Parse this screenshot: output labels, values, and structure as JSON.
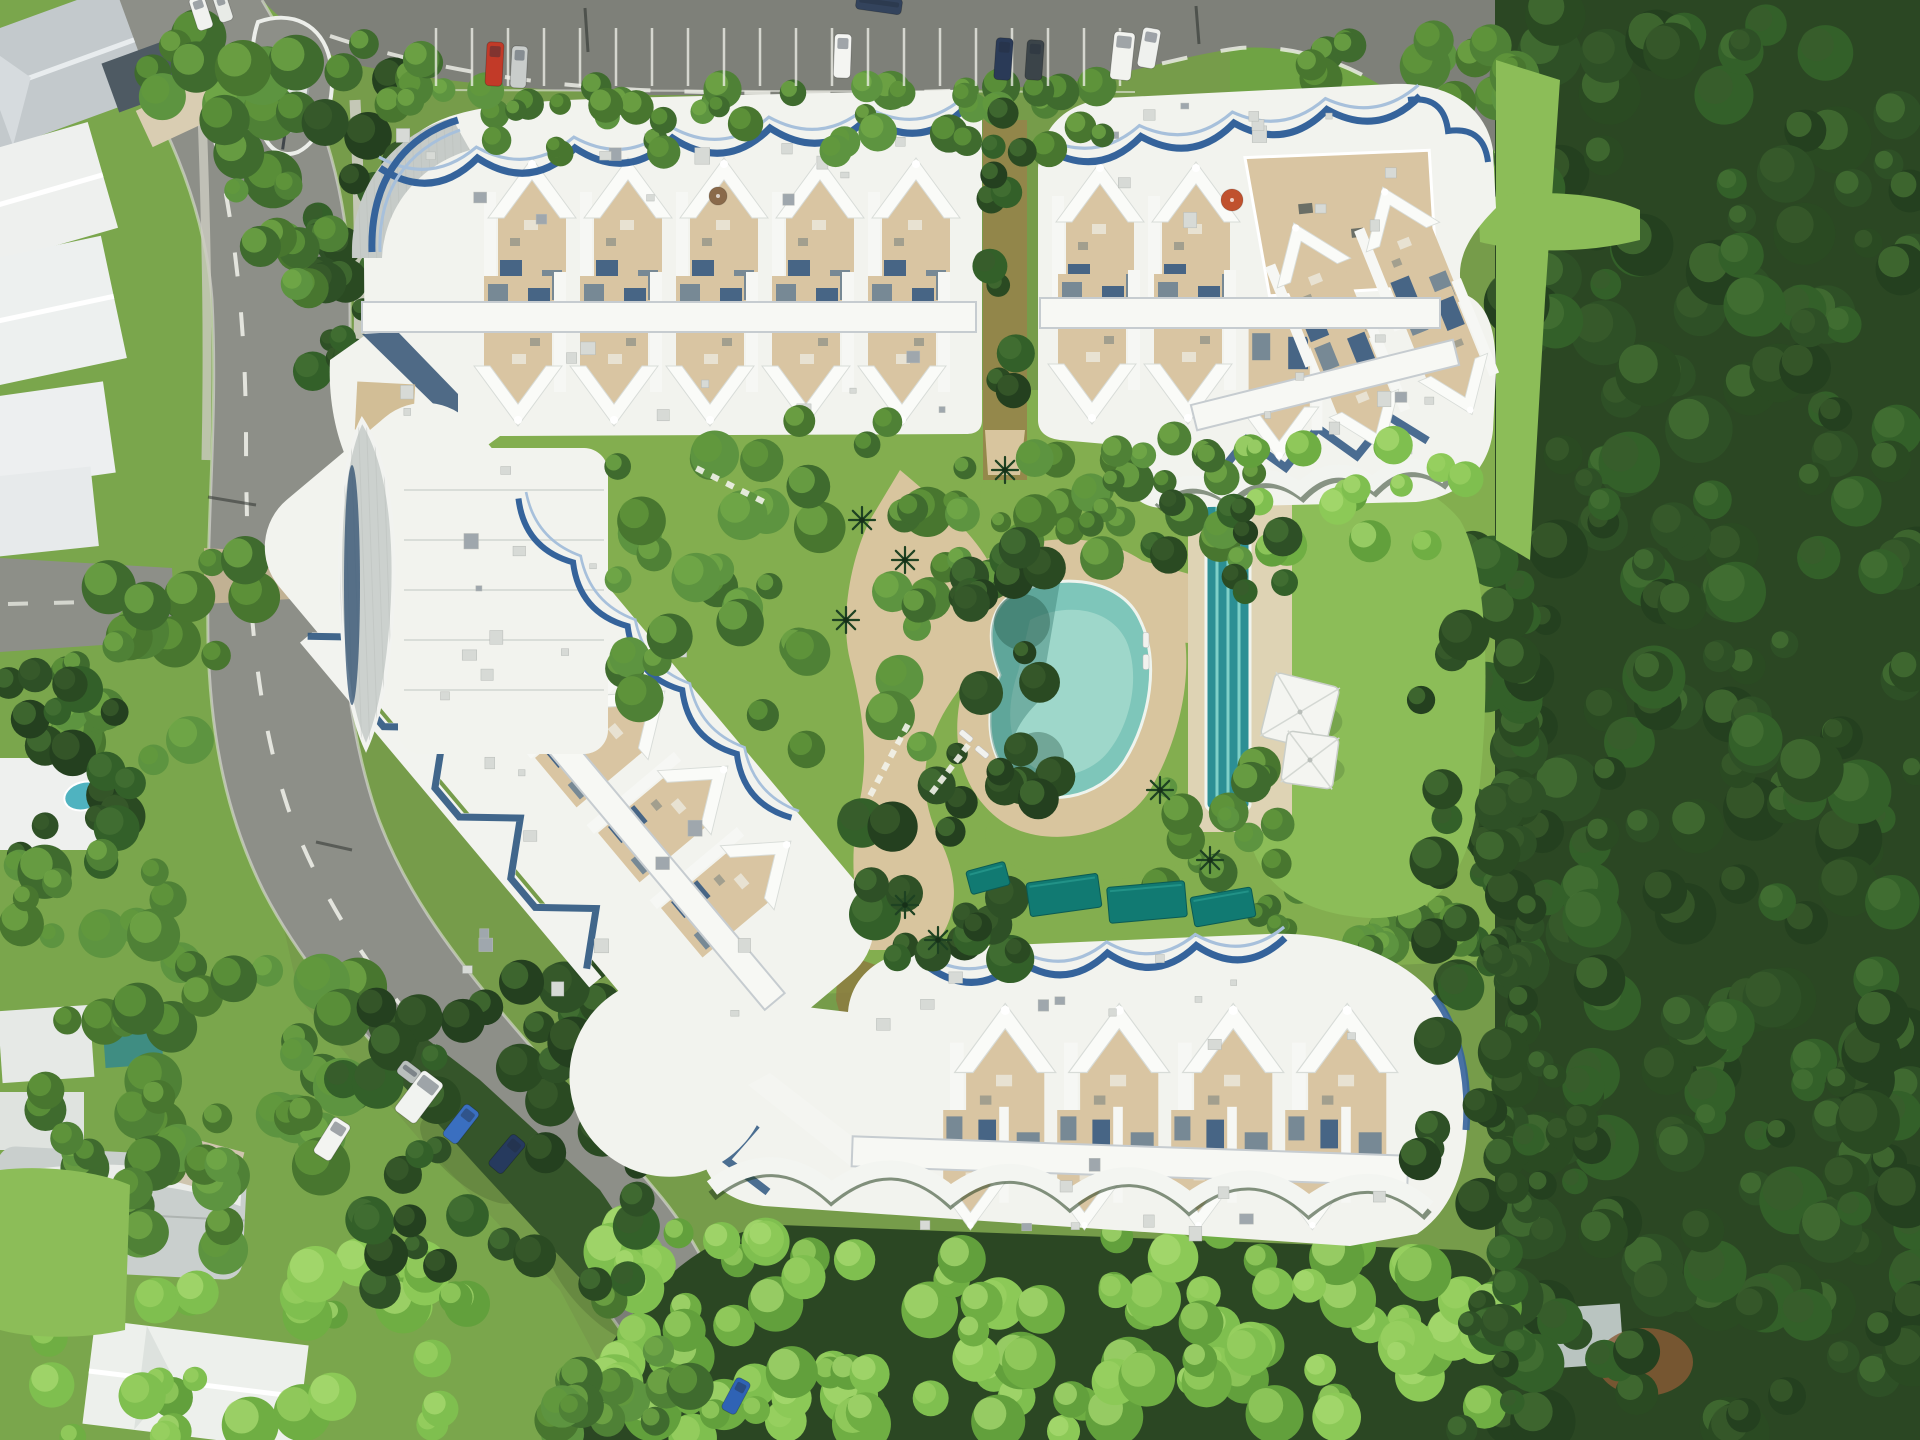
{
  "palette": {
    "road": "#8d8f88",
    "road_dark": "#7e8079",
    "kerb": "#e9eae3",
    "marking": "#f2f3ec",
    "roof": "#f2f3ee",
    "roof_bright": "#fafbf8",
    "trim": "#35639b",
    "trim_light": "#a7c0db",
    "shadow_blue": "#2d5480",
    "terrace": "#d9c5a2",
    "terrace_dark": "#cbb28c",
    "sand": "#d8c59e",
    "sand_light": "#e7dcc0",
    "concrete": "#dfdbce",
    "lawn": "#83ae4f",
    "lawn_bright": "#8cbd58",
    "ground": "#7aa64c",
    "forest": "#2b4723",
    "forest_mid": "#35552a",
    "pool": "#7ec6ba",
    "pool_light": "#a9dccf",
    "pool_deep": "#3a7f74",
    "lap_pool": "#2c8f94",
    "lane": "#7fd0c8",
    "tarp": "#117a72",
    "leaf_roof": "#ccd1ce",
    "navy": "#24466a",
    "gray_roof": "#c6cbc8",
    "stream": "#8d7b40",
    "dirt": "#8a5a34",
    "boat": "#e3e7e4",
    "house_gray": "#c3c9cc"
  },
  "tree_palettes": {
    "dark": {
      "base": [
        "#24401f",
        "#2e5026",
        "#336029",
        "#2a4a22"
      ],
      "hi": [
        "#3a5c2c",
        "#467234"
      ]
    },
    "mid": {
      "base": [
        "#3f6b2e",
        "#4f8136",
        "#5d9440",
        "#48762f"
      ],
      "hi": [
        "#639a3c",
        "#74ab48"
      ]
    },
    "bright": {
      "base": [
        "#6fae43",
        "#7fbf4f",
        "#8cc957",
        "#62a03c"
      ],
      "hi": [
        "#9ad062",
        "#a8da70"
      ]
    }
  },
  "scene": {
    "trees_under": [
      {
        "x": 1505,
        "y": 0,
        "w": 415,
        "h": 1440,
        "n": 230,
        "pal": "dark",
        "rmin": 14,
        "rmax": 34
      },
      {
        "x": 1470,
        "y": 540,
        "w": 60,
        "h": 700,
        "n": 30,
        "pal": "dark",
        "rmin": 12,
        "rmax": 26
      },
      {
        "x": 1250,
        "y": 880,
        "w": 230,
        "h": 70,
        "n": 18,
        "pal": "mid",
        "rmin": 10,
        "rmax": 20
      },
      {
        "x": 1300,
        "y": 40,
        "w": 220,
        "h": 170,
        "n": 26,
        "pal": "mid",
        "rmin": 12,
        "rmax": 26
      },
      {
        "x": 600,
        "y": 1230,
        "w": 900,
        "h": 210,
        "n": 110,
        "pal": "bright",
        "rmin": 14,
        "rmax": 30
      },
      {
        "x": 540,
        "y": 1300,
        "w": 160,
        "h": 140,
        "n": 16,
        "pal": "mid",
        "rmin": 12,
        "rmax": 24
      },
      {
        "x": 1460,
        "y": 1250,
        "w": 60,
        "h": 190,
        "n": 10,
        "pal": "dark",
        "rmin": 12,
        "rmax": 24
      },
      {
        "x": 150,
        "y": 30,
        "w": 200,
        "h": 150,
        "n": 16,
        "pal": "mid",
        "rmin": 14,
        "rmax": 30
      },
      {
        "x": 290,
        "y": 60,
        "w": 120,
        "h": 200,
        "n": 12,
        "pal": "dark",
        "rmin": 12,
        "rmax": 26
      },
      {
        "x": 60,
        "y": 560,
        "w": 210,
        "h": 200,
        "n": 22,
        "pal": "mid",
        "rmin": 12,
        "rmax": 28
      },
      {
        "x": 0,
        "y": 660,
        "w": 140,
        "h": 240,
        "n": 18,
        "pal": "dark",
        "rmin": 12,
        "rmax": 26
      },
      {
        "x": 10,
        "y": 850,
        "w": 200,
        "h": 180,
        "n": 20,
        "pal": "mid",
        "rmin": 12,
        "rmax": 28
      },
      {
        "x": 130,
        "y": 950,
        "w": 230,
        "h": 230,
        "n": 26,
        "pal": "mid",
        "rmin": 14,
        "rmax": 30
      },
      {
        "x": 0,
        "y": 1090,
        "w": 250,
        "h": 160,
        "n": 20,
        "pal": "mid",
        "rmin": 12,
        "rmax": 26
      },
      {
        "x": 230,
        "y": 1260,
        "w": 240,
        "h": 180,
        "n": 20,
        "pal": "bright",
        "rmin": 14,
        "rmax": 30
      },
      {
        "x": 40,
        "y": 1290,
        "w": 170,
        "h": 150,
        "n": 14,
        "pal": "bright",
        "rmin": 12,
        "rmax": 26
      },
      {
        "x": 300,
        "y": 260,
        "w": 90,
        "h": 140,
        "n": 10,
        "pal": "dark",
        "rmin": 10,
        "rmax": 22
      },
      {
        "x": 230,
        "y": 180,
        "w": 110,
        "h": 120,
        "n": 10,
        "pal": "mid",
        "rmin": 10,
        "rmax": 22
      },
      {
        "x": 340,
        "y": 960,
        "w": 300,
        "h": 330,
        "n": 40,
        "pal": "dark",
        "rmin": 12,
        "rmax": 26
      }
    ],
    "trees_over": [
      {
        "x": 420,
        "y": 84,
        "w": 710,
        "h": 70,
        "n": 44,
        "pal": "mid",
        "rmin": 10,
        "rmax": 20
      },
      {
        "x": 978,
        "y": 110,
        "w": 54,
        "h": 340,
        "n": 12,
        "pal": "dark",
        "rmin": 10,
        "rmax": 20
      },
      {
        "x": 600,
        "y": 420,
        "w": 330,
        "h": 330,
        "n": 40,
        "pal": "mid",
        "rmin": 12,
        "rmax": 26
      },
      {
        "x": 930,
        "y": 430,
        "w": 260,
        "h": 150,
        "n": 22,
        "pal": "mid",
        "rmin": 10,
        "rmax": 22
      },
      {
        "x": 950,
        "y": 540,
        "w": 110,
        "h": 260,
        "n": 18,
        "pal": "dark",
        "rmin": 10,
        "rmax": 22
      },
      {
        "x": 1090,
        "y": 430,
        "w": 170,
        "h": 130,
        "n": 14,
        "pal": "mid",
        "rmin": 10,
        "rmax": 22
      },
      {
        "x": 1150,
        "y": 760,
        "w": 130,
        "h": 150,
        "n": 14,
        "pal": "mid",
        "rmin": 10,
        "rmax": 22
      },
      {
        "x": 850,
        "y": 770,
        "w": 170,
        "h": 200,
        "n": 20,
        "pal": "dark",
        "rmin": 12,
        "rmax": 26
      },
      {
        "x": 1240,
        "y": 430,
        "w": 240,
        "h": 120,
        "n": 16,
        "pal": "bright",
        "rmin": 10,
        "rmax": 22
      },
      {
        "x": 1420,
        "y": 560,
        "w": 110,
        "h": 600,
        "n": 28,
        "pal": "dark",
        "rmin": 12,
        "rmax": 26
      },
      {
        "x": 1150,
        "y": 500,
        "w": 140,
        "h": 110,
        "n": 10,
        "pal": "dark",
        "rmin": 10,
        "rmax": 20
      },
      {
        "x": 330,
        "y": 40,
        "w": 120,
        "h": 70,
        "n": 8,
        "pal": "mid",
        "rmin": 10,
        "rmax": 20
      },
      {
        "x": 1480,
        "y": 900,
        "w": 120,
        "h": 300,
        "n": 14,
        "pal": "dark",
        "rmin": 12,
        "rmax": 24
      }
    ],
    "parking_bays": {
      "x1": 436,
      "x2": 1128,
      "step": 36,
      "y1": 28,
      "y2": 86
    },
    "cars": [
      {
        "x": 486,
        "y": 42,
        "w": 17,
        "h": 44,
        "rot": 3,
        "c": "#c23a28"
      },
      {
        "x": 511,
        "y": 46,
        "w": 16,
        "h": 42,
        "rot": 3,
        "c": "#c9cdcb"
      },
      {
        "x": 834,
        "y": 34,
        "w": 17,
        "h": 44,
        "rot": 2,
        "c": "#f4f5f2"
      },
      {
        "x": 856,
        "y": -4,
        "w": 46,
        "h": 16,
        "rot": 8,
        "c": "#33435c"
      },
      {
        "x": 995,
        "y": 38,
        "w": 17,
        "h": 42,
        "rot": 4,
        "c": "#2a3a57"
      },
      {
        "x": 1026,
        "y": 40,
        "w": 17,
        "h": 40,
        "rot": 4,
        "c": "#3b4449"
      },
      {
        "x": 1112,
        "y": 32,
        "w": 21,
        "h": 48,
        "rot": 6,
        "c": "#f2f3ef"
      },
      {
        "x": 1140,
        "y": 28,
        "w": 18,
        "h": 40,
        "rot": 10,
        "c": "#eff1ee"
      },
      {
        "x": 193,
        "y": -4,
        "w": 16,
        "h": 34,
        "rot": -18,
        "c": "#f1f2ef"
      },
      {
        "x": 216,
        "y": -6,
        "w": 14,
        "h": 28,
        "rot": -18,
        "c": "#e8ebe7"
      },
      {
        "x": 398,
        "y": 1064,
        "w": 22,
        "h": 16,
        "rot": 37,
        "c": "#b9bfbd"
      },
      {
        "x": 406,
        "y": 1072,
        "w": 26,
        "h": 50,
        "rot": 37,
        "c": "#f1f3f0"
      },
      {
        "x": 452,
        "y": 1104,
        "w": 18,
        "h": 40,
        "rot": 38,
        "c": "#3a6fc0"
      },
      {
        "x": 498,
        "y": 1134,
        "w": 18,
        "h": 40,
        "rot": 40,
        "c": "#263a5e"
      },
      {
        "x": 322,
        "y": 1118,
        "w": 20,
        "h": 42,
        "rot": 32,
        "c": "#f3f4f1"
      },
      {
        "x": 728,
        "y": 1378,
        "w": 16,
        "h": 36,
        "rot": 28,
        "c": "#2f63b5"
      }
    ],
    "trims": [
      {
        "x1": 380,
        "y1": 168,
        "x2": 965,
        "y2": 108,
        "n": 6,
        "amp": 20,
        "w": 7,
        "color": "#35639b",
        "inner": true
      },
      {
        "x1": 1048,
        "y1": 150,
        "x2": 1420,
        "y2": 96,
        "n": 4,
        "amp": 18,
        "w": 7,
        "color": "#35639b",
        "inner": true
      },
      {
        "x1": 1408,
        "y1": 100,
        "x2": 1488,
        "y2": 162,
        "n": 2,
        "amp": -13,
        "w": 6,
        "color": "#35639b",
        "inner": false
      },
      {
        "x1": 1158,
        "y1": 508,
        "x2": 1448,
        "y2": 486,
        "n": 4,
        "amp": -16,
        "w": 9,
        "color": "#1c3317",
        "op": 0.5,
        "inner": false
      },
      {
        "x1": 1154,
        "y1": 500,
        "x2": 1446,
        "y2": 478,
        "n": 4,
        "amp": -15,
        "w": 13,
        "color": "#f2f4f0",
        "inner": false
      },
      {
        "x1": 930,
        "y1": 968,
        "x2": 1285,
        "y2": 938,
        "n": 4,
        "amp": 18,
        "w": 7,
        "color": "#35639b",
        "inner": true
      },
      {
        "x1": 712,
        "y1": 1196,
        "x2": 1428,
        "y2": 1216,
        "n": 6,
        "amp": -26,
        "w": 11,
        "color": "#223c1e",
        "op": 0.55,
        "inner": false
      },
      {
        "x1": 712,
        "y1": 1188,
        "x2": 1428,
        "y2": 1208,
        "n": 6,
        "amp": -24,
        "w": 17,
        "color": "#f3f5f1",
        "inner": false
      },
      {
        "x1": 140,
        "y1": 2,
        "x2": 560,
        "y2": -2,
        "n": 5,
        "amp": 14,
        "w": 6,
        "color": "#35639b",
        "inner": true,
        "transform": "translate(430,390) rotate(50)"
      }
    ],
    "units": [
      {
        "parent": "g-units-a",
        "xs": [
          484,
          580,
          676,
          772,
          868
        ],
        "y": 148,
        "scale": 1.0,
        "rot": 0
      },
      {
        "parent": "g-units-a2",
        "xs": [
          470,
          566,
          662,
          758,
          854
        ],
        "y": 436,
        "scale": 1.0,
        "rot": 180
      },
      {
        "parent": "g-units-b",
        "xs": [
          1052,
          1148
        ],
        "y": 152,
        "scale": 1.0,
        "rot": 0
      },
      {
        "parent": "g-units-b2",
        "xs": [
          1044,
          1140
        ],
        "y": 434,
        "scale": 1.0,
        "rot": 180
      },
      {
        "parent": "g-units-b2",
        "xs": [
          1236
        ],
        "y": 470,
        "scale": 0.9,
        "rot": 180
      },
      {
        "parent": "g-units-ne",
        "xs": [
          1282,
          1378
        ],
        "y": 206,
        "scale": 0.9,
        "rot": 0
      },
      {
        "parent": "g-units-ne",
        "xs": [
          1282,
          1378
        ],
        "y": 468,
        "scale": 0.85,
        "rot": 180
      },
      {
        "parent": "g-units-s",
        "xs": [
          950,
          1064,
          1178,
          1292
        ],
        "y": 992,
        "scale": 1.15,
        "rot": 0
      },
      {
        "parent": "g-units-s2",
        "xs": [
          932,
          1046,
          1160,
          1274
        ],
        "y": 1238,
        "scale": 0.8,
        "rot": 180
      },
      {
        "parent": "g-units-sw",
        "xs": [
          140,
          238,
          336,
          434,
          532
        ],
        "y": 4,
        "scale": 0.95,
        "rot": 0
      }
    ],
    "vents": [
      {
        "x": 390,
        "y": 118,
        "w": 560,
        "h": 100,
        "n": 14
      },
      {
        "x": 380,
        "y": 340,
        "w": 560,
        "h": 80,
        "n": 10
      },
      {
        "x": 1060,
        "y": 100,
        "w": 380,
        "h": 120,
        "n": 12
      },
      {
        "x": 1250,
        "y": 320,
        "w": 200,
        "h": 140,
        "n": 8
      },
      {
        "x": 870,
        "y": 950,
        "w": 540,
        "h": 90,
        "n": 12
      },
      {
        "x": 880,
        "y": 1150,
        "w": 500,
        "h": 80,
        "n": 10
      },
      {
        "x": 450,
        "y": 600,
        "w": 300,
        "h": 420,
        "n": 16
      },
      {
        "x": 410,
        "y": 460,
        "w": 190,
        "h": 280,
        "n": 8
      }
    ],
    "stones": [
      {
        "x1": 872,
        "y1": 792,
        "x2": 906,
        "y2": 728,
        "n": 6
      },
      {
        "x1": 934,
        "y1": 790,
        "x2": 966,
        "y2": 748,
        "n": 5
      },
      {
        "x1": 700,
        "y1": 470,
        "x2": 760,
        "y2": 500,
        "n": 5
      }
    ],
    "tarps": [
      {
        "x": 1028,
        "y": 878,
        "w": 72,
        "h": 34,
        "rot": -8
      },
      {
        "x": 1108,
        "y": 884,
        "w": 78,
        "h": 36,
        "rot": -5
      },
      {
        "x": 1192,
        "y": 892,
        "w": 62,
        "h": 30,
        "rot": -10
      },
      {
        "x": 968,
        "y": 866,
        "w": 40,
        "h": 24,
        "rot": -15
      }
    ],
    "sails": [
      {
        "x": 1300,
        "y": 712,
        "s": 66,
        "rot": 14
      },
      {
        "x": 1310,
        "y": 760,
        "s": 52,
        "rot": 8
      }
    ],
    "umbrellas": [
      {
        "x": 1232,
        "y": 200,
        "r": 11,
        "c": "#c0512e"
      },
      {
        "x": 718,
        "y": 196,
        "r": 9,
        "c": "#8a6a4a"
      }
    ],
    "loungers": [
      {
        "x": 966,
        "y": 736,
        "rot": 40
      },
      {
        "x": 982,
        "y": 752,
        "rot": 40
      },
      {
        "x": 1146,
        "y": 640,
        "rot": 90
      },
      {
        "x": 1146,
        "y": 662,
        "rot": 90
      }
    ],
    "palms": [
      {
        "x": 862,
        "y": 520
      },
      {
        "x": 905,
        "y": 560
      },
      {
        "x": 846,
        "y": 620
      },
      {
        "x": 1005,
        "y": 470
      },
      {
        "x": 1160,
        "y": 790
      },
      {
        "x": 905,
        "y": 905
      },
      {
        "x": 938,
        "y": 940
      },
      {
        "x": 1210,
        "y": 860
      }
    ]
  }
}
